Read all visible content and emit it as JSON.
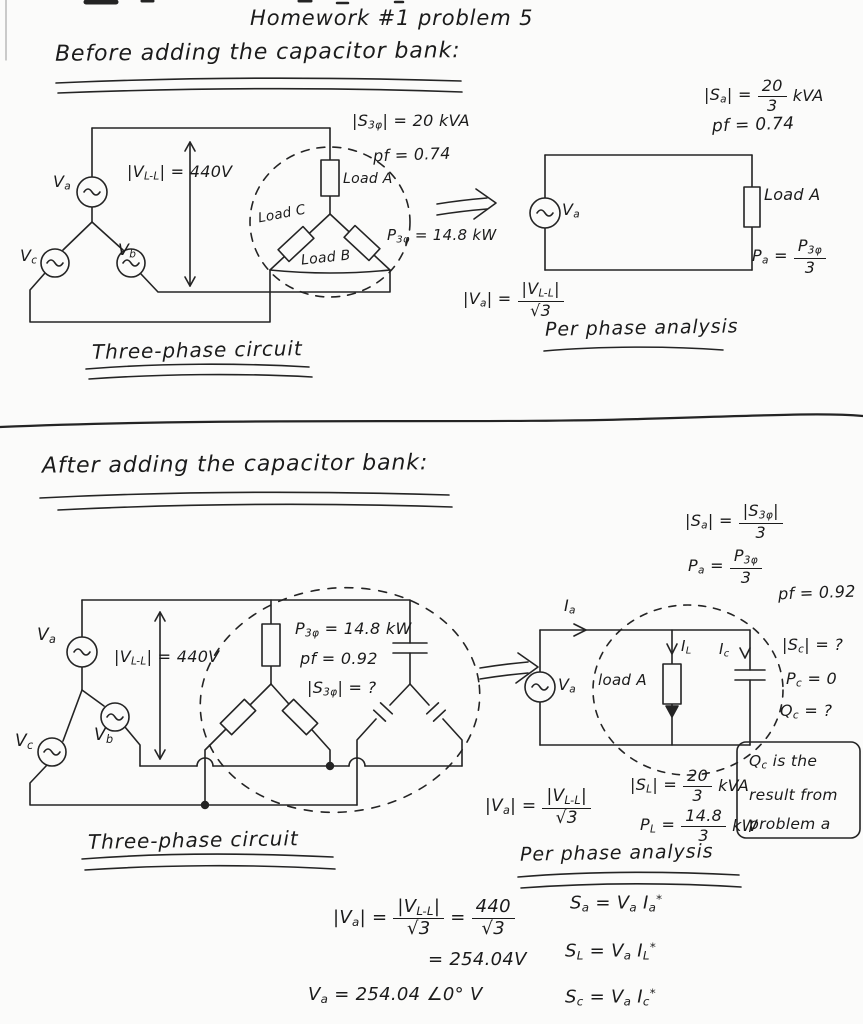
{
  "title": "Homework #1  problem 5",
  "before": {
    "heading": "Before adding the capacitor bank:",
    "sa": {
      "lhs": "|S_{a}| =",
      "num": "20",
      "den": "3",
      "unit": "kVA"
    },
    "pf_right": "pf = 0.74",
    "s3p": "|S_{3φ}| = 20 kVA",
    "pf_left": "pf = 0.74",
    "vll": "|V_{L-L}| = 440V",
    "va": "V_{a}",
    "vb": "V_{b}",
    "vc": "V_{c}",
    "load_a": "Load A",
    "load_b": "Load B",
    "load_c": "Load C",
    "p3p": "P_{3φ} = 14.8 kW",
    "caption": "Three-phase circuit",
    "pp": {
      "va_src": "V_{a}",
      "load_a": "Load A",
      "pa": {
        "lhs": "P_{a} =",
        "num": "P_{3φ}",
        "den": "3",
        "unit": ""
      },
      "va_eq": {
        "lhs": "|V_{a}| =",
        "num": "|V_{L-L}|",
        "den": "√3",
        "unit": ""
      },
      "caption": "Per phase analysis"
    }
  },
  "after": {
    "heading": "After adding the capacitor bank:",
    "sa": {
      "lhs": "|S_{a}| =",
      "num": "|S_{3φ}|",
      "den": "3",
      "unit": ""
    },
    "pa": {
      "lhs": "P_{a} =",
      "num": "P_{3φ}",
      "den": "3",
      "unit": ""
    },
    "pf_right": "pf = 0.92",
    "vll": "|V_{L-L}| = 440V",
    "va": "V_{a}",
    "vb": "V_{b}",
    "vc": "V_{c}",
    "p3p": "P_{3φ} = 14.8 kW",
    "pf_left": "pf = 0.92",
    "s3p": "|S_{3φ}| = ?",
    "caption": "Three-phase circuit",
    "pp": {
      "ia": "I_{a}",
      "il": "I_{L}",
      "ic": "I_{c}",
      "va_src": "V_{a}",
      "load_a": "load A",
      "sc": "|S_{c}| = ?",
      "pc": "P_{c} = 0",
      "qc": "Q_{c} = ?",
      "note_l1": "Q_{c} is the",
      "note_l2": "result from",
      "note_l3": "problem a",
      "va_eq": {
        "lhs": "|V_{a}| =",
        "num": "|V_{L-L}|",
        "den": "√3",
        "unit": ""
      },
      "sl": {
        "lhs": "|S_{L}| =",
        "num": "20",
        "den": "3",
        "unit": "kVA"
      },
      "pl": {
        "lhs": "P_{L} =",
        "num": "14.8",
        "den": "3",
        "unit": "kW"
      },
      "caption": "Per phase analysis"
    }
  },
  "work": {
    "va_calc": {
      "lhs": "|V_{a}| =",
      "num1": "|V_{L-L}|",
      "den1": "√3",
      "eq": "=",
      "num2": "440",
      "den2": "√3"
    },
    "va_result": "= 254.04V",
    "va_phasor": "V_{a} = 254.04 ∠0° V",
    "sa_eq": "S_{a} = V_{a} I_{a}^{*}",
    "sl_eq": "S_{L} = V_{a} I_{L}^{*}",
    "sc_eq": "S_{c} = V_{a} I_{c}^{*}"
  }
}
